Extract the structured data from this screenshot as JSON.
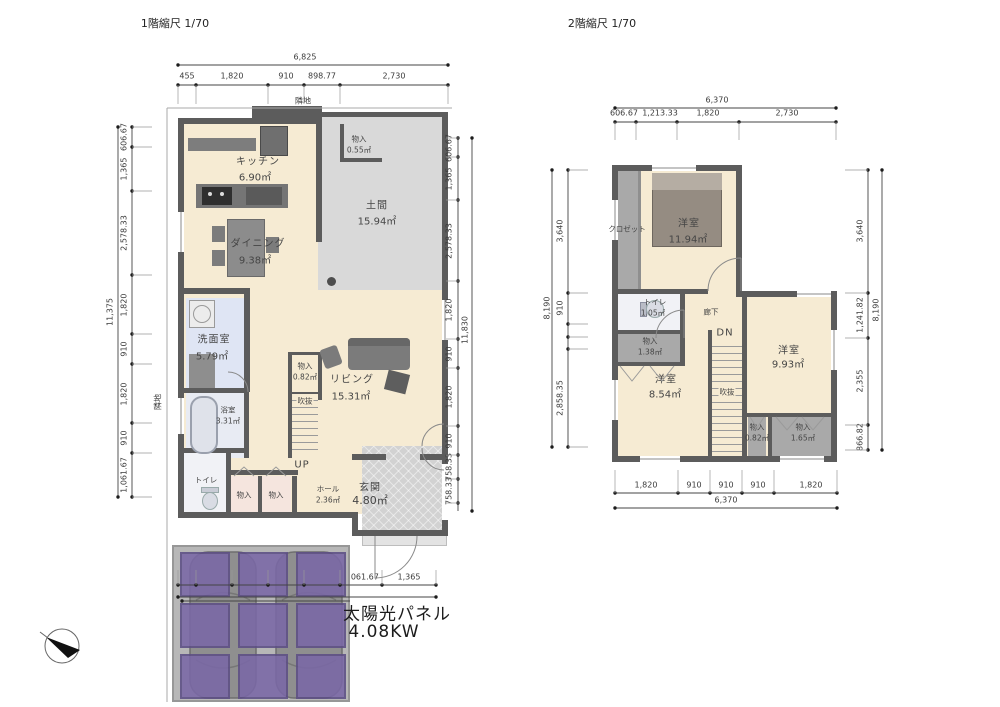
{
  "floor1": {
    "title": "1階縮尺 1/70",
    "site_label_top": "隣地",
    "site_label_left": "隣地",
    "dims": {
      "top_total": "6,825",
      "top_segments": [
        "455",
        "1,820",
        "910",
        "898.77",
        "2,730"
      ],
      "left_total": "11,375",
      "left_segments": [
        "606.67",
        "1,365",
        "2,578.33",
        "1,820",
        "910",
        "1,820",
        "910",
        "1,061.67"
      ],
      "right_total": "11,830",
      "right_segments": [
        "606.67",
        "1,365",
        "2,578.33",
        "1,820",
        "910",
        "1,820",
        "910",
        "758.33",
        "758.33"
      ],
      "bottom_total": "6,825",
      "bottom_segments": [
        "455",
        "910",
        "910",
        "910",
        "910",
        "1,061.67",
        "1,365"
      ]
    },
    "rooms": {
      "kitchen": {
        "name": "キッチン",
        "area": "6.90㎡"
      },
      "storage_top": {
        "name": "物入",
        "area": "0.55㎡"
      },
      "doma": {
        "name": "土間",
        "area": "15.94㎡"
      },
      "dining": {
        "name": "ダイニング",
        "area": "9.38㎡"
      },
      "washroom": {
        "name": "洗面室",
        "area": "5.79㎡"
      },
      "living": {
        "name": "リビング",
        "area": "15.31㎡"
      },
      "storage_stair": {
        "name": "物入",
        "area": "0.82㎡"
      },
      "void": {
        "name": "吹抜"
      },
      "bath": {
        "name": "浴室",
        "area": "3.31㎡"
      },
      "toilet": {
        "name": "トイレ"
      },
      "storage_a": {
        "name": "物入"
      },
      "storage_b": {
        "name": "物入"
      },
      "hall": {
        "name": "ホール",
        "area": "2.36㎡"
      },
      "entrance": {
        "name": "玄関",
        "area": "4.80㎡"
      },
      "stairs_up": "UP"
    }
  },
  "floor2": {
    "title": "2階縮尺 1/70",
    "dims": {
      "top_total": "6,370",
      "top_segments": [
        "606.67",
        "1,213.33",
        "1,820",
        "2,730"
      ],
      "left_total": "8,190",
      "left_segments": [
        "3,640",
        "910",
        "2,858.35"
      ],
      "right_total": "8,190",
      "right_segments": [
        "3,640",
        "1,241.82",
        "2,355",
        "866.82"
      ],
      "bottom_total": "6,370",
      "bottom_segments": [
        "1,820",
        "910",
        "910",
        "910",
        "1,820"
      ]
    },
    "rooms": {
      "closet": {
        "name": "クロゼット"
      },
      "bedroom_main": {
        "name": "洋室",
        "area": "11.94㎡"
      },
      "toilet": {
        "name": "トイレ",
        "area": "1.05㎡"
      },
      "hallway": {
        "name": "廊下"
      },
      "storage_hall": {
        "name": "物入",
        "area": "1.38㎡"
      },
      "stairs_down": "DN",
      "void": {
        "name": "吹抜"
      },
      "bedroom_left": {
        "name": "洋室",
        "area": "8.54㎡"
      },
      "bedroom_right": {
        "name": "洋室",
        "area": "9.93㎡"
      },
      "storage_r1": {
        "name": "物入",
        "area": "0.82㎡"
      },
      "storage_r2": {
        "name": "物入",
        "area": "1.65㎡"
      }
    }
  },
  "solar": {
    "label": "太陽光パネル",
    "capacity": "4.08KW"
  },
  "colors": {
    "wall": "#5c5c5c",
    "wood_floor": "#f6ebd3",
    "doma_gray": "#d9d9d9",
    "solar_purple": "#7a68a6",
    "washroom_blue": "#dfe5f4"
  }
}
